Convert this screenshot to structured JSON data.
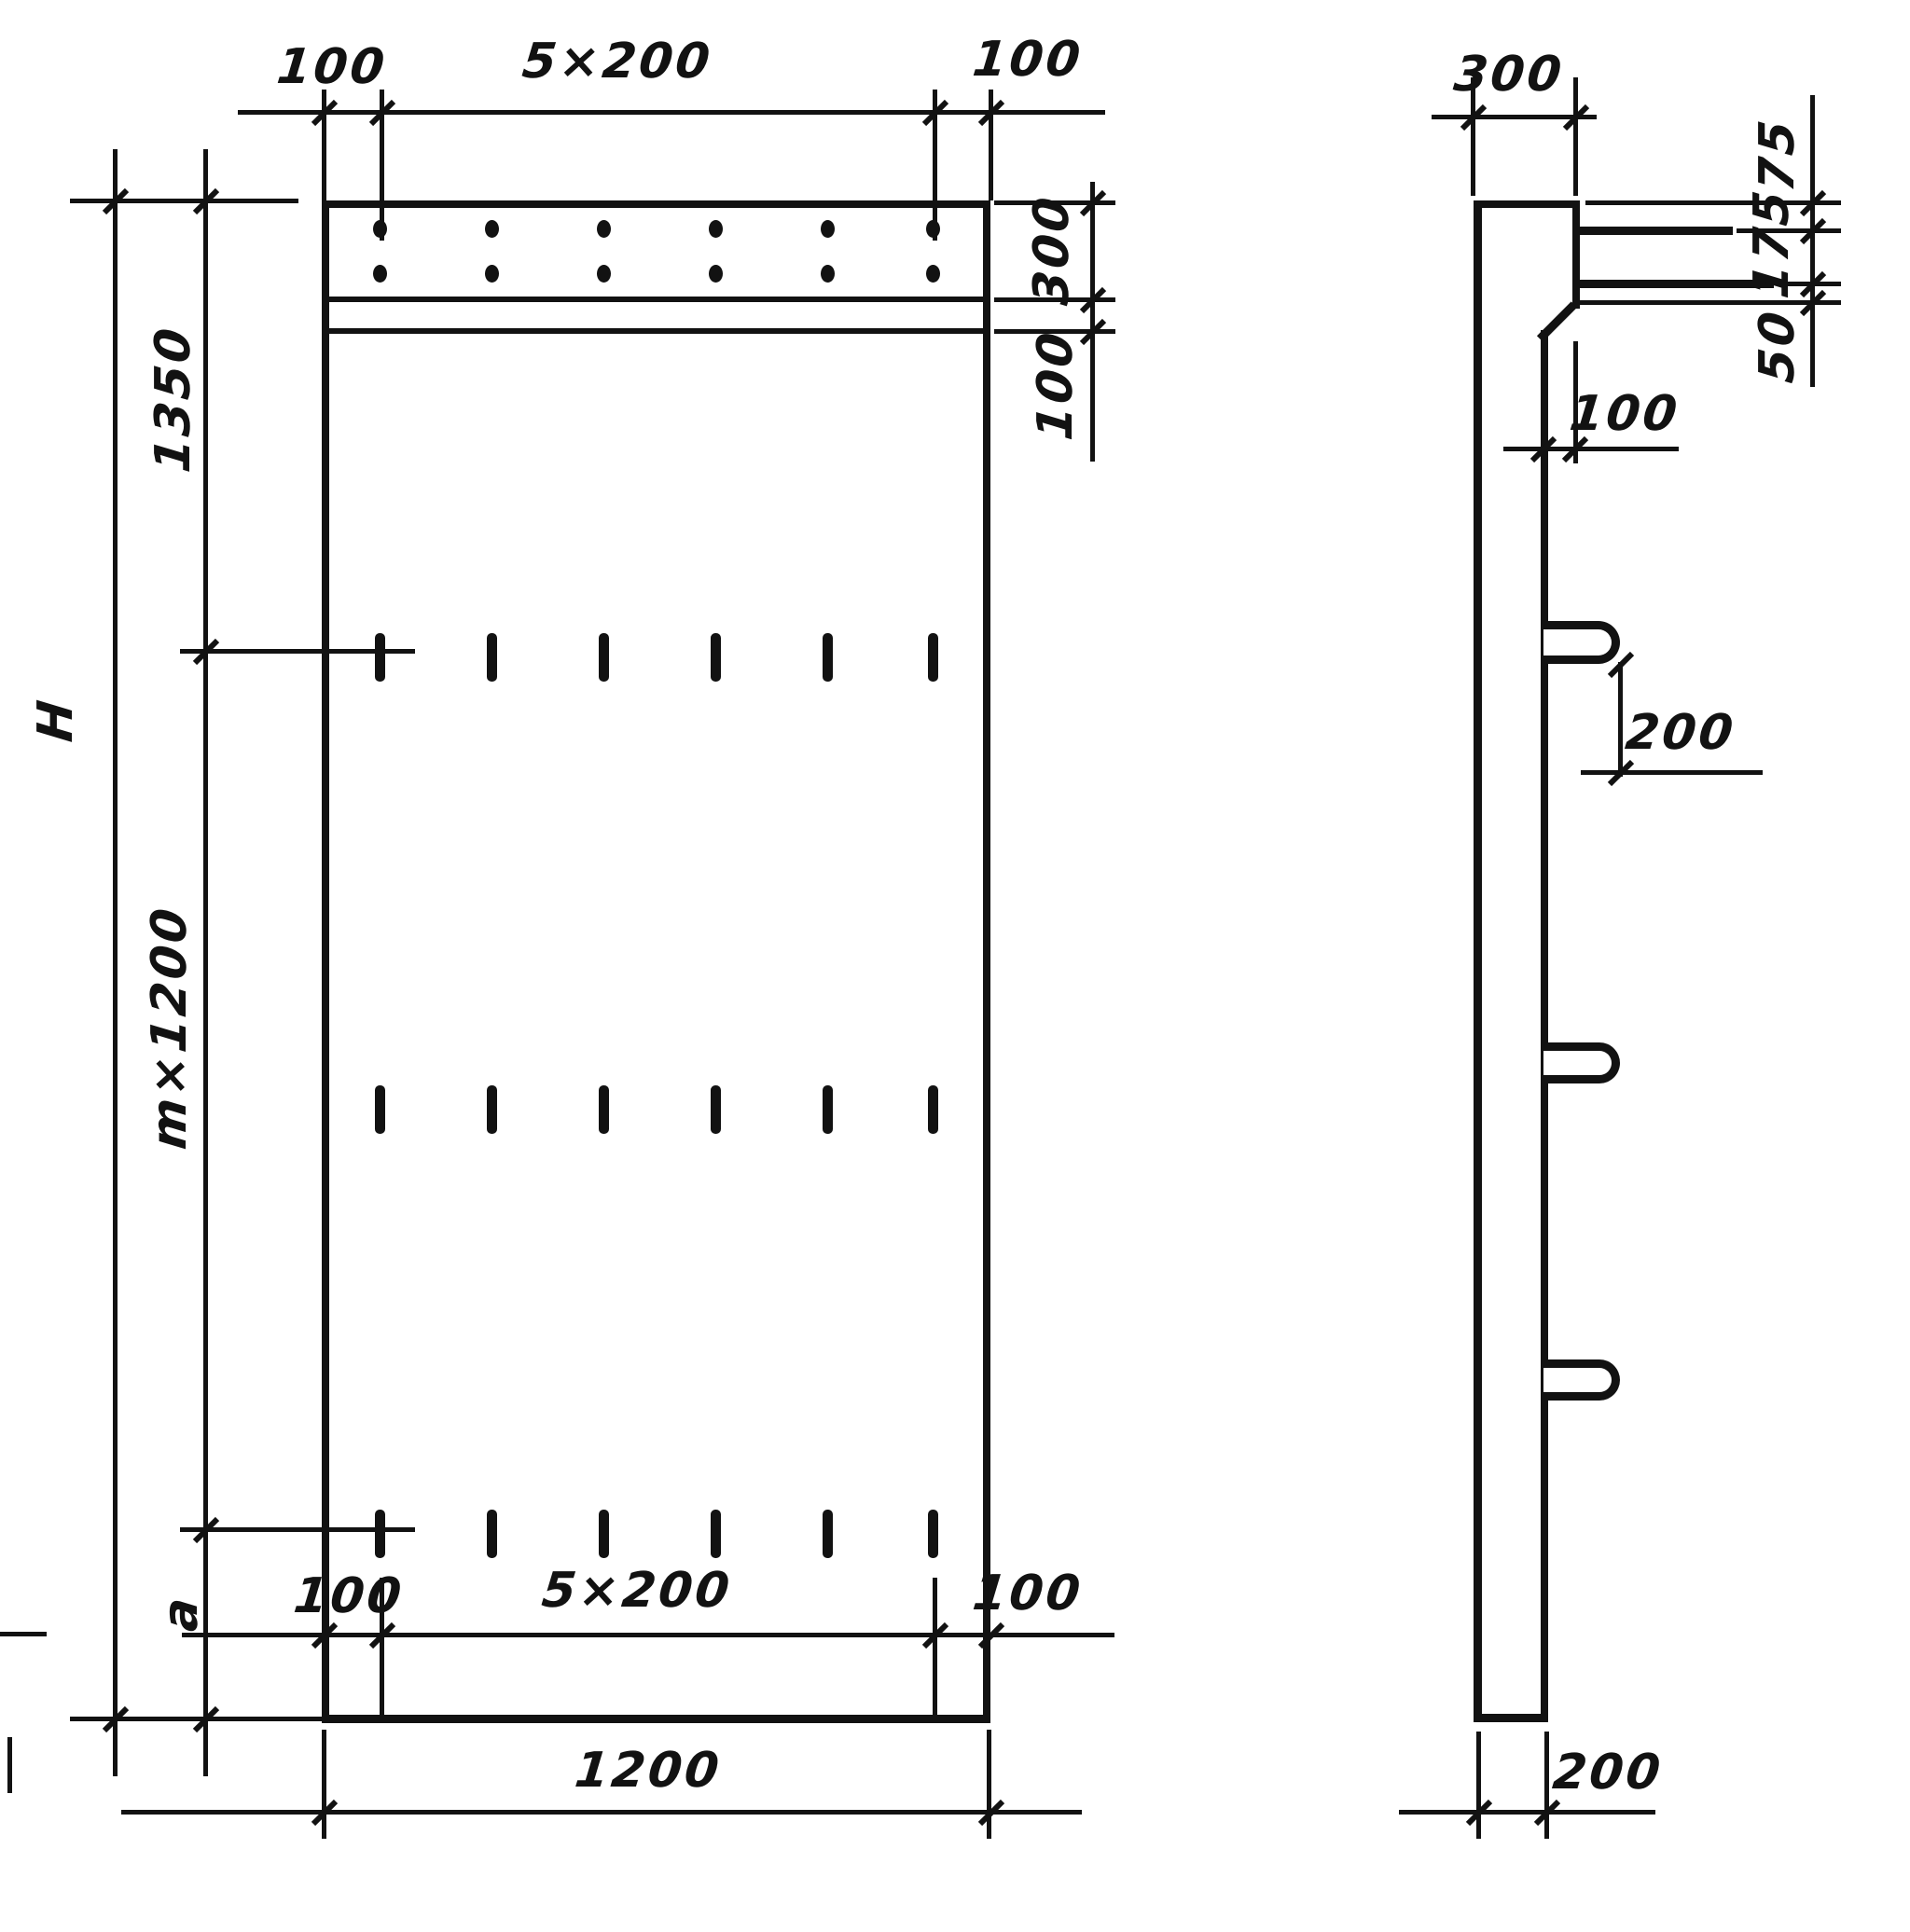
{
  "front_view": {
    "top_dims": [
      "100",
      "5×200",
      "100"
    ],
    "right_dims": [
      "300",
      "100"
    ],
    "left_dims": {
      "overall": "H",
      "top": "1350",
      "middle": "m×1200",
      "bottom": "a"
    },
    "bottom_dims": [
      "100",
      "5×200",
      "100"
    ],
    "overall_width": "1200"
  },
  "side_view": {
    "thickness_top": "300",
    "right_dims": [
      "75",
      "175",
      "50"
    ],
    "ledge_offset": "100",
    "loop_spacing": "200",
    "thickness_bottom": "200"
  }
}
